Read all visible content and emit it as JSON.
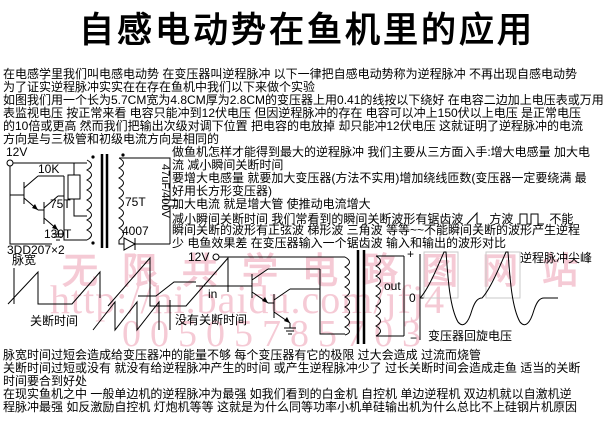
{
  "page": {
    "title": "自感电动势在鱼机里的应用",
    "text_color": "#000000",
    "background": "#ffffff",
    "watermark_color": "#ee9fb4"
  },
  "intro_lines": [
    "在电感学里我们叫电感电动势 在变压器叫逆程脉冲 以下一律把自感电动势称为逆程脉冲 不再出现自感电动势",
    "为了证实逆程脉冲实实在在存在鱼机中我们以下来做个实验",
    "如图我们用一个长为5.7CM宽为4.8CM厚为2.8CM的变压器上用0.41的线按以下绕好 在电容二边加上电压表或万用",
    "表监视电压 按正常来看 电容只能冲到12伏电压 但因逆程脉冲的存在 电容可以冲上150伏以上电压 是正常电压",
    "的10倍或更高 然而我们把输出次级对调下位置 把电容的电放掉 却只能冲12伏电压 这就证明了逆程脉冲的电流",
    "方向是与三极管和初级电流方向是相同的"
  ],
  "methods": {
    "l1": "做鱼机怎样才能得到最大的逆程脉冲 我们主要从三方面入手:增大电感量 加大电",
    "l2": "流 减小瞬间关断时间",
    "l3": "要增大电感量 就要加大变压器(方法不实用)增加绕线匝数(变压器一定要绕满 最",
    "l4": "好用长方形变压器)",
    "l5": "加大电流 就是增大管 使推动电流增大",
    "l6a": "减小瞬间关断时间 我们常看到的瞬间关断波形有锯齿波",
    "l6b": "方波",
    "l6c": "不能",
    "l7": "瞬间关断的波形有正弦波 梯形波 三角波 等等~~不能瞬间关断的波形产生逆程",
    "l8": "少 电鱼效果差 在变压器输入一个锯齿波 输入和输出的波形对比"
  },
  "circuit1": {
    "supply": "12V",
    "resistor": "10K",
    "primary_top_turns": "75T",
    "primary_bottom_turns": "130T",
    "transistor_type": "3DD207×2",
    "secondary_turns": "75T",
    "diode_type": "4007",
    "capacitor_value": "47uF/400V"
  },
  "diagram": {
    "pulse_width_label": "脉宽",
    "off_time_label": "关断时间",
    "no_off_time_label": "没有关断时间",
    "supply_label": "12V",
    "input_label": "in",
    "output_label": "out",
    "axis_plus": "+",
    "axis_zero": "0",
    "axis_minus": "−",
    "spike_label": "逆程脉冲尖峰",
    "ring_label": "变压器回旋电压"
  },
  "watermark": {
    "line1": "无限共学电路图网站",
    "line2": "http://hi.baidu.com/jfj4",
    "line3": "00505785703"
  },
  "footer_lines": [
    "脉宽时间过短会造成给变压器冲的能量不够 每个变压器有它的极限 过大会造成 过流而烧管",
    "关断时间过短或没有 就没有给逆程脉冲产生的时间 或产生逆程脉冲少了 过长关断时间会造成走鱼 适当的关断",
    "时间要合到好处",
    "在现实鱼机之中 一般单边机的逆程脉冲为最强 如我们看到的白金机 自控机 单边逆程机 双边机就以自激机逆",
    "程脉冲最强 如反激励自控机 灯炮机等等 这就是为什么同等功率小机单硅输出机为什么总比不上硅钢片机原因"
  ]
}
